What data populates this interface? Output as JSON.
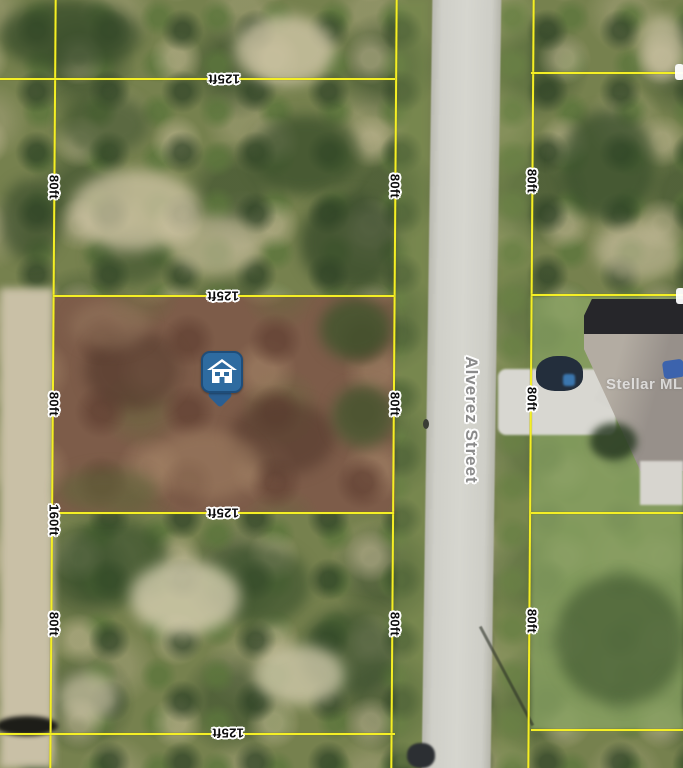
{
  "map": {
    "description": "Aerial parcel map with lot dimension overlay",
    "street_label": "Alverez Street",
    "watermark": "Stellar MLS",
    "dim_width": "125ft",
    "dim_depth": "80ft",
    "dim_depth_double": "160ft",
    "marker": {
      "icon": "house-marker-icon",
      "color": "#2e6ba0"
    },
    "colors": {
      "parcel_line_yellow": "#f4ef25",
      "subject_lot_brown": "#7d5c49",
      "road_gray": "#cfcfc8",
      "marker_blue": "#2e6ba0"
    }
  }
}
